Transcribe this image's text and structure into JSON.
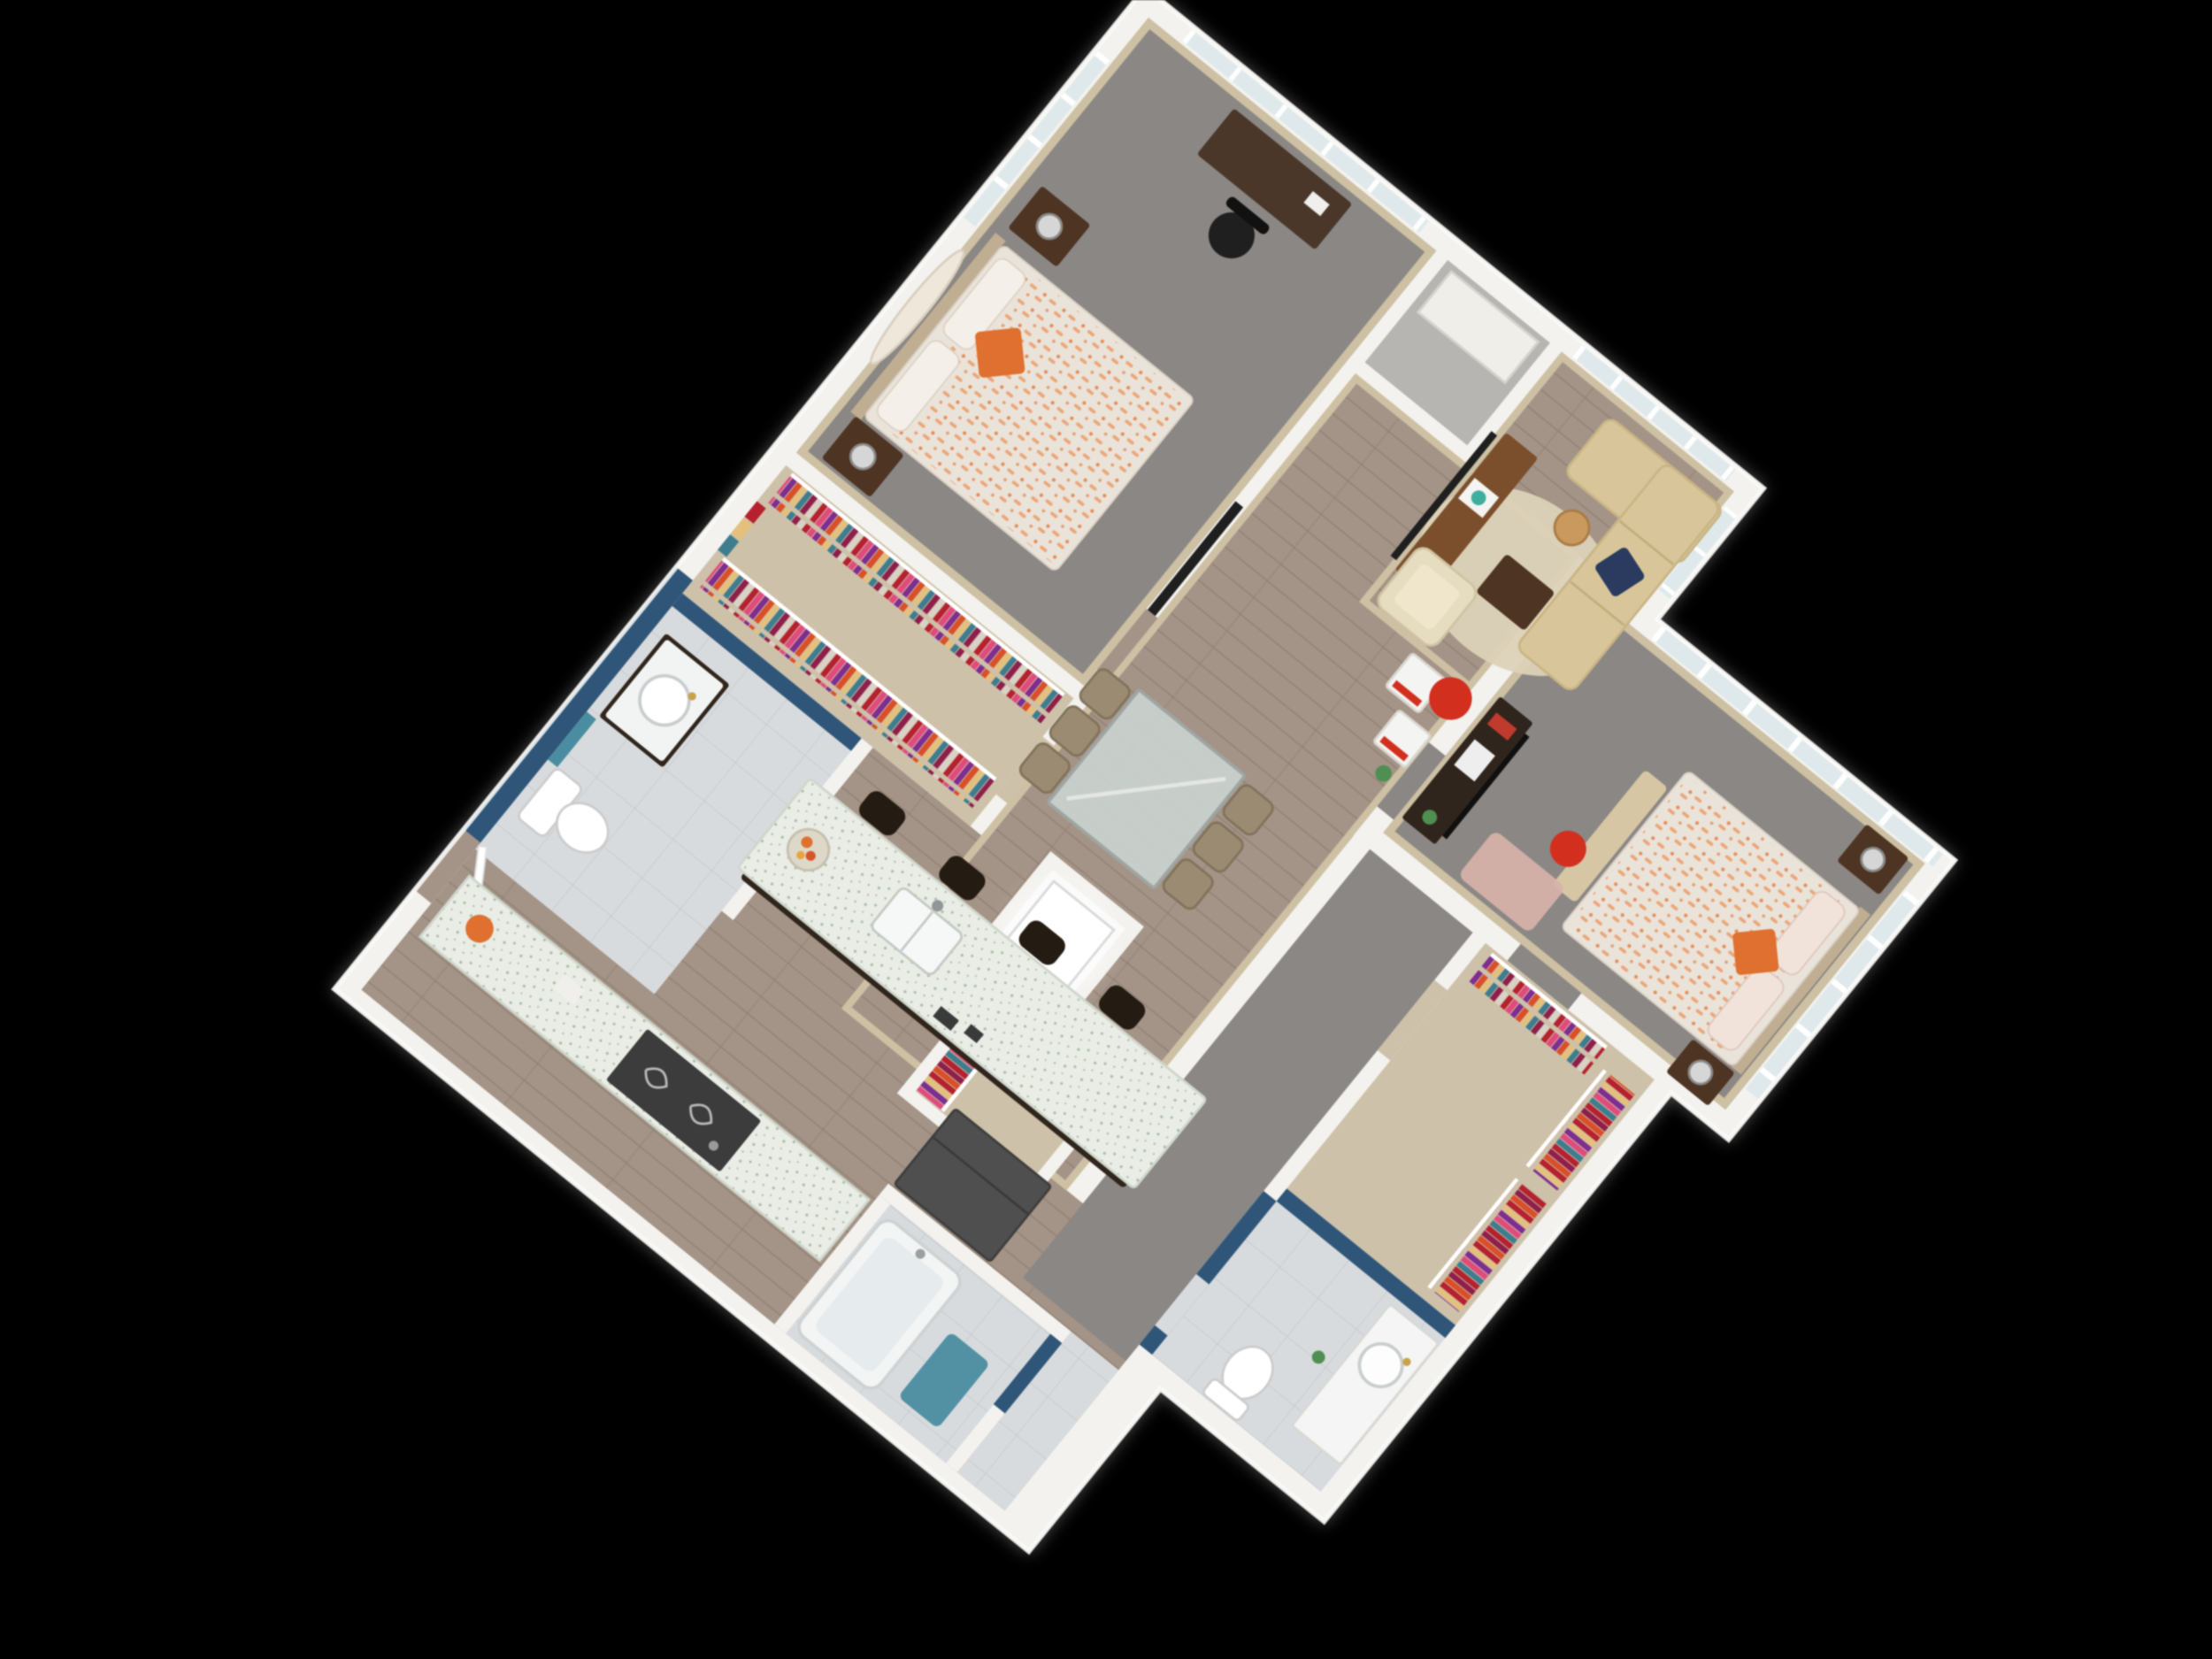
{
  "scene": {
    "description": "3D isometric dollhouse-style floor plan render of a two-bedroom, two-bathroom apartment, viewed from above at an angle on a solid black background",
    "view": "top-down 3D render rotated approximately 39 degrees",
    "background_color": "#000000",
    "bedrooms": 2,
    "bathrooms": 2,
    "visible_text": ""
  },
  "palette": {
    "wall": "#f3f2ee",
    "wallEdge": "#dedbd4",
    "wallTan": "#cdc0a3",
    "carpet": "#8b8784",
    "wood": "#a49487",
    "woodLine": "#8f7f72",
    "tile": "#d8dbde",
    "tileLine": "#c3c7ca",
    "closetFloor": "#cec1a9",
    "nookFloor": "#b7b5b2",
    "blue": "#2f5679",
    "glass": "#dfe9ec",
    "sofa": "#d8c69a",
    "sofaLine": "#c2ad7c",
    "cream": "#e6dcc0",
    "rug": "#dcd2b8",
    "brown": "#7c4f2c",
    "darkBrown": "#4e3422",
    "darkWood": "#30251c",
    "granite": "#e9ede5",
    "graniteDot": "#a9b8a6",
    "bedBase": "#eae3d9",
    "bedPat": "#eba679",
    "orange": "#df7030",
    "navy": "#2a3b5f",
    "red": "#d22f1f",
    "teal": "#4b8da0",
    "silver": "#d6d6d6",
    "dark": "#1f1f1f",
    "appliance": "#4f4f4f",
    "pink": "#d7b2aa",
    "green": "#4f8f52",
    "gold": "#c9a24a",
    "white": "#ffffff",
    "headboard": "#bfae92",
    "chair": "#9a8b72",
    "chairEdge": "#81735c",
    "c1": "#b5212e",
    "c2": "#e04b7c",
    "c3": "#7e2e8e",
    "c4": "#d94f27",
    "c5": "#e3c07c",
    "c6": "#3e7d8e",
    "c7": "#8e1f4b",
    "c8": "#d9d2c6"
  },
  "rooms": [
    {
      "id": "bedroom-1",
      "name": "Bedroom 1",
      "floor": "gray carpet",
      "walls": "tan",
      "furniture": [
        "queen bed with orange patterned comforter",
        "orange accent pillow",
        "two white pillows",
        "oval wall mirror",
        "two dark wood nightstands",
        "two silver lamps",
        "desk",
        "black office chair",
        "wall TV",
        "curtained window",
        "window wall"
      ]
    },
    {
      "id": "walk-in-closet-1",
      "name": "Walk-in Closet 1",
      "floor": "light wood",
      "furniture": [
        "two rails of multicolor hanging clothes",
        "white shelving with folded clothes"
      ]
    },
    {
      "id": "bathroom-1",
      "name": "Bathroom 1",
      "floor": "gray tile",
      "accent_wall": "navy blue",
      "furniture": [
        "dark vanity with round white sink",
        "gold faucet",
        "toilet",
        "teal towel"
      ]
    },
    {
      "id": "storage-nook",
      "name": "Storage Nook",
      "floor": "gray",
      "furniture": [
        "white shelf"
      ]
    },
    {
      "id": "living-room",
      "name": "Living Room",
      "floor": "hardwood",
      "furniture": [
        "tan L-shaped sectional sofa",
        "navy throw pillow",
        "cream armchair",
        "round cream rug",
        "dark brown coffee table",
        "wood cylinder side table",
        "brown media console",
        "flat-screen TV",
        "teal decor tray",
        "red round ottoman",
        "two white cube side tables with red bases",
        "green plant"
      ]
    },
    {
      "id": "dining-area",
      "name": "Dining Area",
      "floor": "hardwood",
      "furniture": [
        "glass dining table with metal legs",
        "six taupe dining chairs"
      ]
    },
    {
      "id": "kitchen",
      "name": "Kitchen",
      "floor": "hardwood",
      "furniture": [
        "granite island with dark wood base",
        "island sink with faucet",
        "fruit bowl",
        "four dark bar stools",
        "granite counter run",
        "dark cooktop stove with scroll burners",
        "gray refrigerator",
        "orange canister"
      ]
    },
    {
      "id": "laundry-closet",
      "name": "Laundry Closet",
      "floor": "white",
      "furniture": [
        "white washer/dryer unit (bright highlight)"
      ]
    },
    {
      "id": "hall-closet",
      "name": "Hall Closet",
      "floor": "light wood",
      "furniture": [
        "rail of multicolor hanging clothes"
      ]
    },
    {
      "id": "bedroom-2",
      "name": "Bedroom 2",
      "floor": "gray carpet",
      "walls": "tan",
      "furniture": [
        "queen bed with orange patterned comforter",
        "orange accent pillow",
        "pink pillows",
        "tan storage bench",
        "two nightstands with silver lamps",
        "dark wood dresser/bookshelf with red and white decor",
        "TV",
        "pink patterned rug",
        "red round stool",
        "large paned picture window",
        "second window wall"
      ]
    },
    {
      "id": "closet-2",
      "name": "Closet 2",
      "floor": "light wood",
      "furniture": [
        "two stepped rails of multicolor hanging clothes",
        "top rail of clothes"
      ]
    },
    {
      "id": "bathroom-2",
      "name": "Bathroom 2",
      "floor": "gray tile",
      "accent_wall": "navy blue",
      "furniture": [
        "white vanity with round sink",
        "gold faucet",
        "toilet",
        "green accent item"
      ]
    },
    {
      "id": "tub-room",
      "name": "Tub Room",
      "floor": "gray tile",
      "accent_wall": "navy blue",
      "furniture": [
        "white bathtub",
        "teal bath mat"
      ]
    }
  ],
  "exterior": {
    "window_walls": [
      "bedroom 1 north",
      "bedroom 1 west (curtained)",
      "living room north",
      "living room east",
      "bedroom 2 north (large panes)",
      "bedroom 2 east"
    ],
    "entry": "door on southwest wall near kitchen"
  }
}
